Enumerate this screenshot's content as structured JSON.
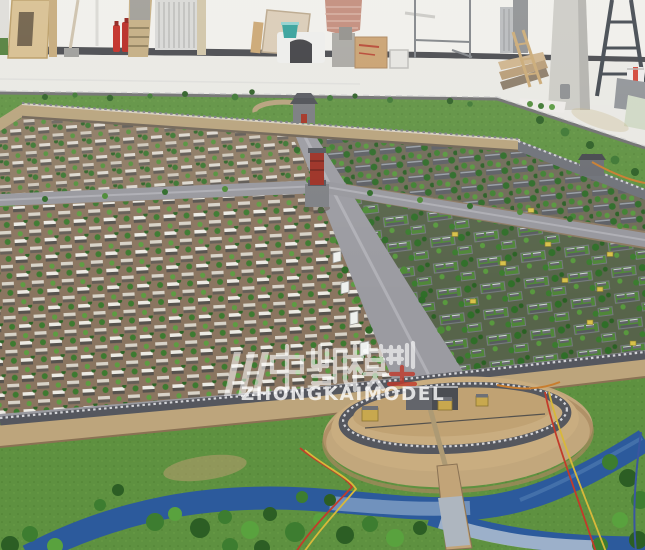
{
  "meta": {
    "description": "Photograph of an architectural scale model of an ancient Chinese walled city displayed inside a workshop",
    "width_px": 645,
    "height_px": 550
  },
  "watermark": {
    "cjk": "中凯模型",
    "latin": "ZHONGKAIMODEL",
    "color": "#ffffff",
    "seal_red": "#c0392b"
  },
  "palette": {
    "warehouse_wall": "#f0efea",
    "warehouse_floor": "#e9e8e3",
    "baseboard": "#45464a",
    "model_ground_brown": "#8d7a63",
    "city_wall_tan": "#b7a27b",
    "wall_grey": "#55575e",
    "road_grey": "#9b9ba1",
    "tree_green_dark": "#2f6b28",
    "tree_green_light": "#4c8a36",
    "lawn_green": "#4f8738",
    "grass_outside": "#5e9140",
    "moat_blue": "#2c5a9c",
    "red_tower": "#9c2f23",
    "fire_extinguisher_red": "#c0271f",
    "teal_bucket": "#2f9e98",
    "wood_tan": "#d6bd8d",
    "yellow_sign": "#d8c24a",
    "wire_red": "#c23b2a",
    "wire_yellow": "#d8b83a",
    "wire_orange": "#c87d2e"
  },
  "scene": {
    "background": "workshop interior with tools and materials",
    "model": "walled-city planning model with tree-lined streets and courtyard houses",
    "landmarks": [
      "north gate tower",
      "central red tower",
      "south barbican gate",
      "moat river"
    ]
  }
}
